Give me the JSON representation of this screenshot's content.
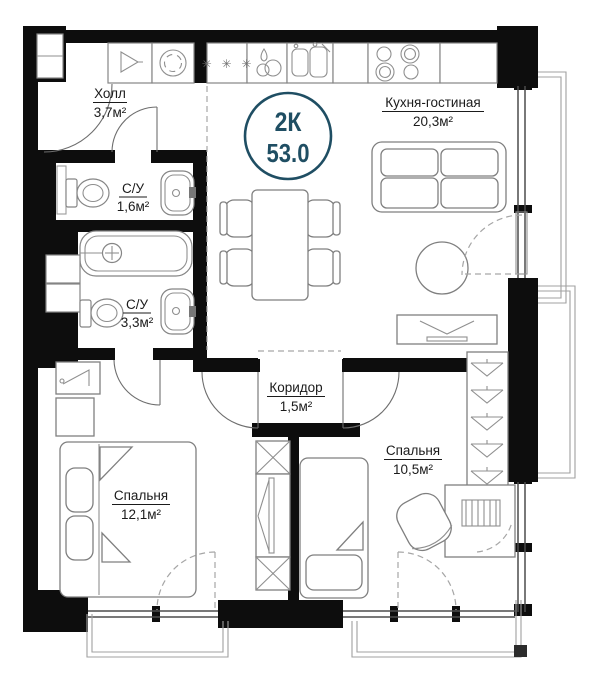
{
  "plan_badge": {
    "type": "2К",
    "area": "53.0",
    "color": "#1f4e63"
  },
  "rooms": {
    "hall": {
      "name": "Холл",
      "area": "3,7м²"
    },
    "bath_small": {
      "name": "С/У",
      "area": "1,6м²"
    },
    "bath_big": {
      "name": "С/У",
      "area": "3,3м²"
    },
    "corridor": {
      "name": "Коридор",
      "area": "1,5м²"
    },
    "kitchen_living": {
      "name": "Кухня-гостиная",
      "area": "20,3м²"
    },
    "bedroom_left": {
      "name": "Спальня",
      "area": "12,1м²"
    },
    "bedroom_right": {
      "name": "Спальня",
      "area": "10,5м²"
    }
  },
  "symbols": {
    "freezer_stars": "✳ ✳ ✳"
  },
  "colors": {
    "walls": "#0d0d0d",
    "badge": "#1f4e63",
    "lines": "#858585"
  }
}
